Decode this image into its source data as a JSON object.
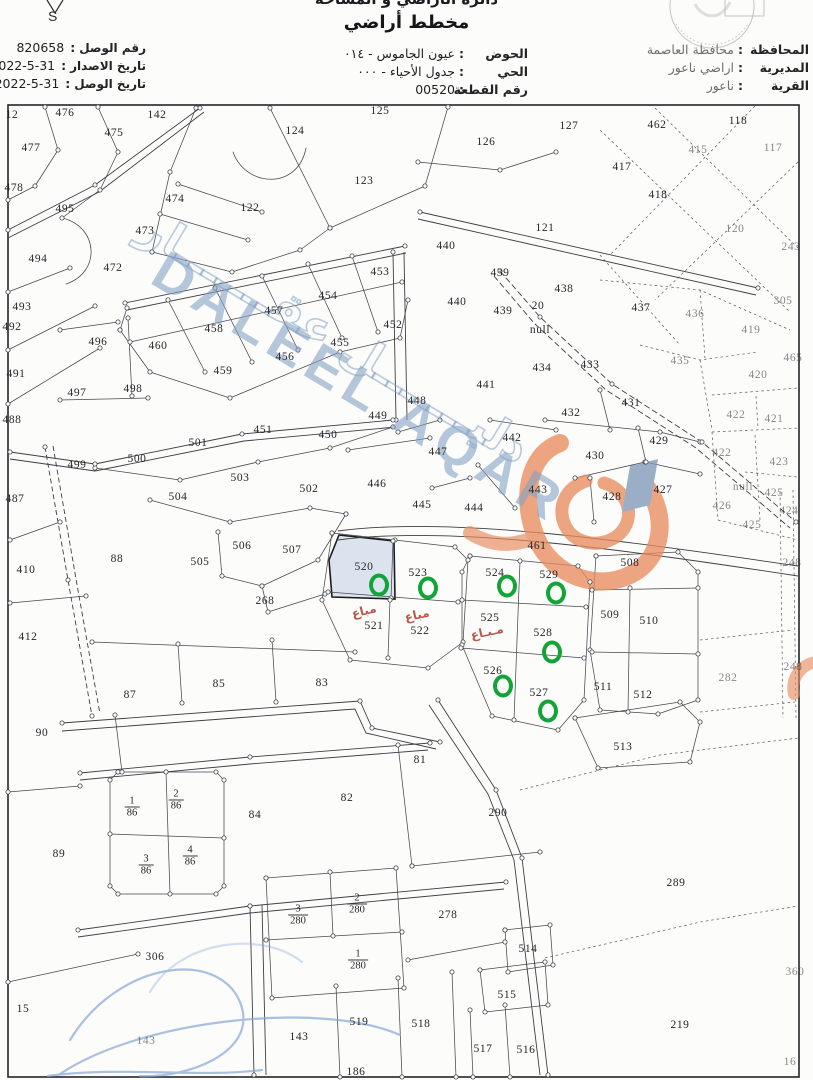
{
  "header": {
    "department_line": "دائرة الأراضي و المساحة",
    "title": "مخطط أراضي",
    "compass_letter": "S",
    "left_fields": [
      {
        "label": "رقم الوصل",
        "value": "820658"
      },
      {
        "label": "تاريخ الاصدار",
        "value": "2022-5-31"
      },
      {
        "label": "تاريخ الوصل",
        "value": "2022-5-31"
      }
    ],
    "center_fields": [
      {
        "label": "الحوض",
        "value": "عيون الجاموس - ٠١٤"
      },
      {
        "label": "الحي",
        "value": "جدول الأحياء - ٠٠٠"
      },
      {
        "label": "رقم القطعة",
        "value": "00520"
      }
    ],
    "right_fields": [
      {
        "label": "المحافظة",
        "value": "محافظة العاصمة"
      },
      {
        "label": "المديرية",
        "value": "اراضي ناعور"
      },
      {
        "label": "القرية",
        "value": "ناعور"
      }
    ]
  },
  "watermark": {
    "text_en": "DALEEL AQAR",
    "text_ar": "دليـــــــل عقـــــــار",
    "text_color": "#84a2c5",
    "logo_color": "#e88a5d",
    "arrow_color": "#7d99b8"
  },
  "map": {
    "line_color": "#46484e",
    "sold_color": "#b0473a",
    "highlight_color": "#13a437",
    "shaded_plot": "520",
    "shaded_fill": "#dbe4ee",
    "plots": [
      {
        "n": "12",
        "x": 12,
        "y": 115
      },
      {
        "n": "476",
        "x": 65,
        "y": 113
      },
      {
        "n": "475",
        "x": 114,
        "y": 133
      },
      {
        "n": "142",
        "x": 157,
        "y": 115
      },
      {
        "n": "124",
        "x": 295,
        "y": 131
      },
      {
        "n": "125",
        "x": 380,
        "y": 111
      },
      {
        "n": "477",
        "x": 31,
        "y": 148
      },
      {
        "n": "126",
        "x": 486,
        "y": 142
      },
      {
        "n": "127",
        "x": 569,
        "y": 126
      },
      {
        "n": "462",
        "x": 657,
        "y": 125
      },
      {
        "n": "118",
        "x": 738,
        "y": 121
      },
      {
        "n": "415",
        "x": 698,
        "y": 150,
        "f": 1
      },
      {
        "n": "117",
        "x": 773,
        "y": 148,
        "f": 1
      },
      {
        "n": "478",
        "x": 14,
        "y": 188
      },
      {
        "n": "123",
        "x": 364,
        "y": 181
      },
      {
        "n": "495",
        "x": 65,
        "y": 209
      },
      {
        "n": "474",
        "x": 175,
        "y": 199
      },
      {
        "n": "122",
        "x": 250,
        "y": 208
      },
      {
        "n": "417",
        "x": 622,
        "y": 167
      },
      {
        "n": "418",
        "x": 658,
        "y": 195
      },
      {
        "n": "473",
        "x": 145,
        "y": 231
      },
      {
        "n": "494",
        "x": 38,
        "y": 259
      },
      {
        "n": "472",
        "x": 113,
        "y": 268
      },
      {
        "n": "121",
        "x": 545,
        "y": 228
      },
      {
        "n": "120",
        "x": 735,
        "y": 229,
        "f": 1
      },
      {
        "n": "243",
        "x": 791,
        "y": 247,
        "f": 1
      },
      {
        "n": "493",
        "x": 22,
        "y": 307
      },
      {
        "n": "453",
        "x": 380,
        "y": 272
      },
      {
        "n": "454",
        "x": 328,
        "y": 296
      },
      {
        "n": "457",
        "x": 274,
        "y": 311
      },
      {
        "n": "452",
        "x": 393,
        "y": 325
      },
      {
        "n": "492",
        "x": 12,
        "y": 327
      },
      {
        "n": "458",
        "x": 214,
        "y": 329
      },
      {
        "n": "440",
        "x": 446,
        "y": 246
      },
      {
        "n": "439",
        "x": 500,
        "y": 273
      },
      {
        "n": "438",
        "x": 564,
        "y": 289
      },
      {
        "n": "20",
        "x": 538,
        "y": 306
      },
      {
        "n": "null",
        "x": 540,
        "y": 330
      },
      {
        "n": "437",
        "x": 641,
        "y": 308
      },
      {
        "n": "436",
        "x": 695,
        "y": 314,
        "f": 1
      },
      {
        "n": "305",
        "x": 783,
        "y": 301,
        "f": 1
      },
      {
        "n": "440",
        "x": 457,
        "y": 302
      },
      {
        "n": "439",
        "x": 503,
        "y": 311
      },
      {
        "n": "419",
        "x": 751,
        "y": 330,
        "f": 1
      },
      {
        "n": "455",
        "x": 340,
        "y": 343
      },
      {
        "n": "456",
        "x": 285,
        "y": 357
      },
      {
        "n": "496",
        "x": 98,
        "y": 342
      },
      {
        "n": "460",
        "x": 158,
        "y": 346
      },
      {
        "n": "491",
        "x": 16,
        "y": 374
      },
      {
        "n": "459",
        "x": 223,
        "y": 371
      },
      {
        "n": "434",
        "x": 542,
        "y": 368
      },
      {
        "n": "433",
        "x": 590,
        "y": 365
      },
      {
        "n": "441",
        "x": 486,
        "y": 385
      },
      {
        "n": "435",
        "x": 680,
        "y": 361,
        "f": 1
      },
      {
        "n": "465",
        "x": 793,
        "y": 358,
        "f": 1
      },
      {
        "n": "420",
        "x": 758,
        "y": 375,
        "f": 1
      },
      {
        "n": "497",
        "x": 77,
        "y": 393
      },
      {
        "n": "498",
        "x": 133,
        "y": 389
      },
      {
        "n": "449",
        "x": 378,
        "y": 416
      },
      {
        "n": "448",
        "x": 417,
        "y": 401
      },
      {
        "n": "431",
        "x": 631,
        "y": 403
      },
      {
        "n": "432",
        "x": 571,
        "y": 413
      },
      {
        "n": "422",
        "x": 736,
        "y": 415,
        "f": 1
      },
      {
        "n": "421",
        "x": 774,
        "y": 419,
        "f": 1
      },
      {
        "n": "488",
        "x": 12,
        "y": 420
      },
      {
        "n": "451",
        "x": 263,
        "y": 430
      },
      {
        "n": "450",
        "x": 328,
        "y": 435
      },
      {
        "n": "501",
        "x": 198,
        "y": 443
      },
      {
        "n": "429",
        "x": 659,
        "y": 441
      },
      {
        "n": "430",
        "x": 595,
        "y": 456
      },
      {
        "n": "422",
        "x": 722,
        "y": 453,
        "f": 1
      },
      {
        "n": "423",
        "x": 779,
        "y": 462,
        "f": 1
      },
      {
        "n": "446",
        "x": 377,
        "y": 484
      },
      {
        "n": "442",
        "x": 512,
        "y": 438
      },
      {
        "n": "447",
        "x": 438,
        "y": 452
      },
      {
        "n": "499",
        "x": 77,
        "y": 465
      },
      {
        "n": "500",
        "x": 137,
        "y": 459
      },
      {
        "n": "503",
        "x": 240,
        "y": 478
      },
      {
        "n": "502",
        "x": 309,
        "y": 489
      },
      {
        "n": "504",
        "x": 178,
        "y": 497
      },
      {
        "n": "445",
        "x": 422,
        "y": 505
      },
      {
        "n": "444",
        "x": 474,
        "y": 508
      },
      {
        "n": "443",
        "x": 538,
        "y": 490
      },
      {
        "n": "428",
        "x": 612,
        "y": 497
      },
      {
        "n": "427",
        "x": 663,
        "y": 490
      },
      {
        "n": "null",
        "x": 743,
        "y": 487,
        "f": 1
      },
      {
        "n": "425",
        "x": 774,
        "y": 493,
        "f": 1
      },
      {
        "n": "426",
        "x": 722,
        "y": 506,
        "f": 1
      },
      {
        "n": "424",
        "x": 789,
        "y": 511,
        "f": 1
      },
      {
        "n": "425",
        "x": 752,
        "y": 525,
        "f": 1
      },
      {
        "n": "487",
        "x": 15,
        "y": 499
      },
      {
        "n": "461",
        "x": 537,
        "y": 546
      },
      {
        "n": "508",
        "x": 630,
        "y": 563
      },
      {
        "n": "248",
        "x": 792,
        "y": 563,
        "f": 1
      },
      {
        "n": "506",
        "x": 242,
        "y": 546
      },
      {
        "n": "507",
        "x": 292,
        "y": 550
      },
      {
        "n": "88",
        "x": 117,
        "y": 559
      },
      {
        "n": "410",
        "x": 26,
        "y": 570
      },
      {
        "n": "505",
        "x": 200,
        "y": 562
      },
      {
        "n": "520",
        "x": 364,
        "y": 567
      },
      {
        "n": "523",
        "x": 418,
        "y": 573
      },
      {
        "n": "524",
        "x": 495,
        "y": 573
      },
      {
        "n": "529",
        "x": 549,
        "y": 575
      },
      {
        "n": "268",
        "x": 265,
        "y": 601
      },
      {
        "n": "509",
        "x": 610,
        "y": 615
      },
      {
        "n": "510",
        "x": 649,
        "y": 621
      },
      {
        "n": "525",
        "x": 490,
        "y": 618
      },
      {
        "n": "521",
        "x": 374,
        "y": 626
      },
      {
        "n": "522",
        "x": 420,
        "y": 631
      },
      {
        "n": "528",
        "x": 543,
        "y": 633
      },
      {
        "n": "412",
        "x": 28,
        "y": 637
      },
      {
        "n": "526",
        "x": 493,
        "y": 671
      },
      {
        "n": "511",
        "x": 603,
        "y": 687
      },
      {
        "n": "512",
        "x": 643,
        "y": 695
      },
      {
        "n": "248",
        "x": 793,
        "y": 667,
        "f": 1
      },
      {
        "n": "282",
        "x": 728,
        "y": 678,
        "f": 1
      },
      {
        "n": "527",
        "x": 539,
        "y": 693
      },
      {
        "n": "87",
        "x": 130,
        "y": 695
      },
      {
        "n": "85",
        "x": 219,
        "y": 684
      },
      {
        "n": "83",
        "x": 322,
        "y": 683
      },
      {
        "n": "90",
        "x": 42,
        "y": 733
      },
      {
        "n": "513",
        "x": 623,
        "y": 747
      },
      {
        "n": "81",
        "x": 420,
        "y": 760
      },
      {
        "n": "84",
        "x": 255,
        "y": 815
      },
      {
        "n": "82",
        "x": 347,
        "y": 798
      },
      {
        "n": "290",
        "x": 498,
        "y": 813
      },
      {
        "n": "89",
        "x": 59,
        "y": 854
      },
      {
        "n": "289",
        "x": 676,
        "y": 883
      },
      {
        "n": "278",
        "x": 448,
        "y": 915
      },
      {
        "n": "306",
        "x": 155,
        "y": 957
      },
      {
        "n": "15",
        "x": 23,
        "y": 1009
      },
      {
        "n": "514",
        "x": 528,
        "y": 949
      },
      {
        "n": "515",
        "x": 507,
        "y": 995
      },
      {
        "n": "360",
        "x": 795,
        "y": 972,
        "f": 1
      },
      {
        "n": "519",
        "x": 359,
        "y": 1022
      },
      {
        "n": "518",
        "x": 421,
        "y": 1024
      },
      {
        "n": "143",
        "x": 299,
        "y": 1037
      },
      {
        "n": "143",
        "x": 146,
        "y": 1041,
        "f": 1
      },
      {
        "n": "219",
        "x": 680,
        "y": 1025
      },
      {
        "n": "517",
        "x": 483,
        "y": 1049
      },
      {
        "n": "516",
        "x": 526,
        "y": 1050
      },
      {
        "n": "186",
        "x": 356,
        "y": 1072
      },
      {
        "n": "16",
        "x": 790,
        "y": 1062,
        "f": 1
      }
    ],
    "fractions": [
      {
        "top": "1",
        "bottom": "86",
        "x": 132,
        "y": 807
      },
      {
        "top": "2",
        "bottom": "86",
        "x": 176,
        "y": 800
      },
      {
        "top": "3",
        "bottom": "86",
        "x": 146,
        "y": 865
      },
      {
        "top": "4",
        "bottom": "86",
        "x": 190,
        "y": 856
      },
      {
        "top": "3",
        "bottom": "280",
        "x": 298,
        "y": 915
      },
      {
        "top": "2",
        "bottom": "280",
        "x": 357,
        "y": 904
      },
      {
        "top": "1",
        "bottom": "280",
        "x": 358,
        "y": 960
      }
    ],
    "sold_labels": [
      {
        "text": "مباع",
        "x": 364,
        "y": 611,
        "rot": -14
      },
      {
        "text": "مباع",
        "x": 417,
        "y": 615,
        "rot": -12
      },
      {
        "text": "مـبـاع",
        "x": 487,
        "y": 632,
        "rot": -12
      }
    ],
    "green_circles": [
      {
        "x": 379,
        "y": 585
      },
      {
        "x": 428,
        "y": 588
      },
      {
        "x": 507,
        "y": 586
      },
      {
        "x": 556,
        "y": 593
      },
      {
        "x": 552,
        "y": 652
      },
      {
        "x": 503,
        "y": 686
      },
      {
        "x": 548,
        "y": 711
      }
    ]
  }
}
